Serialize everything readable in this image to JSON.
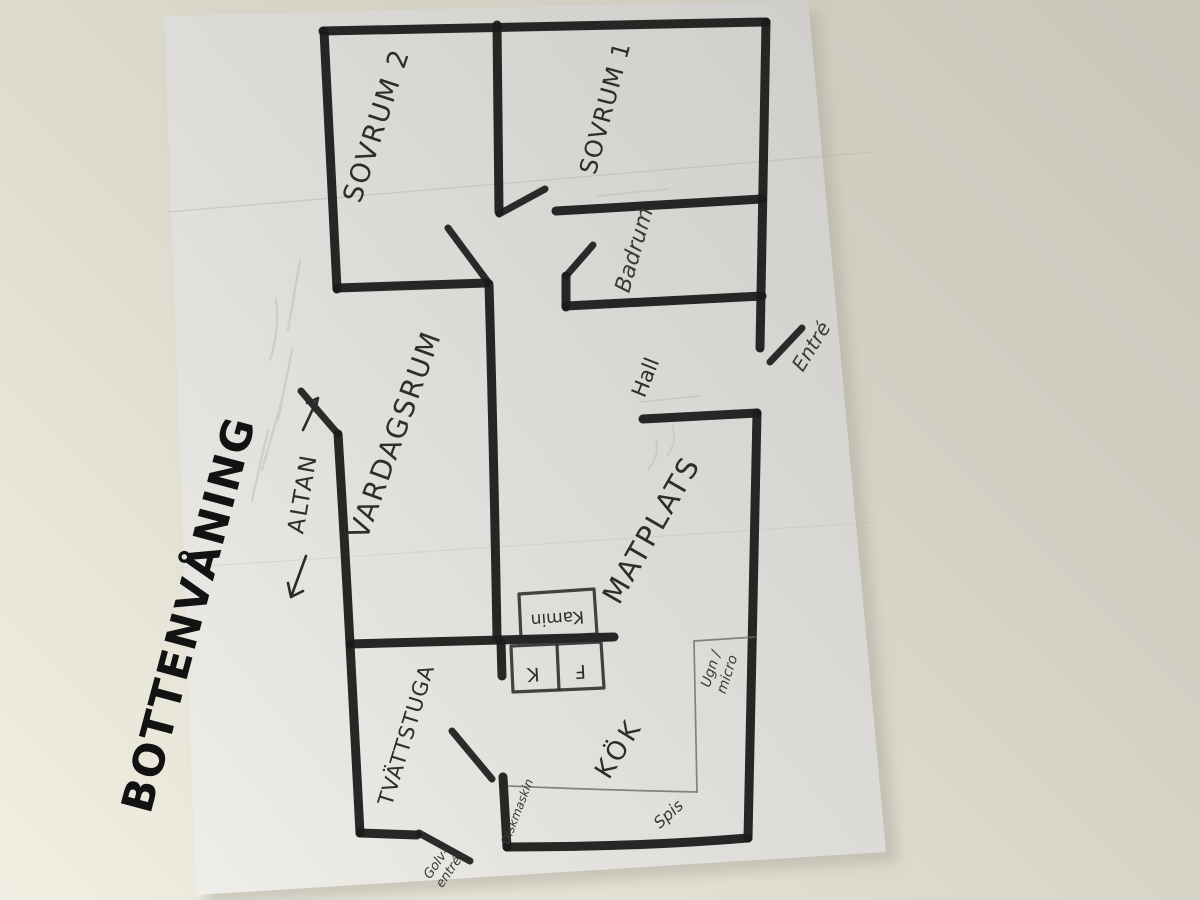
{
  "photo": {
    "paper_color": "#e7e5e0",
    "table_color": "#d5d3c6",
    "ink_color": "#1b1b1b",
    "pencil_color": "#3a3937"
  },
  "title": "BOTTENVÅNING",
  "rooms": {
    "sovrum2": "SOVRUM 2",
    "sovrum1": "SOVRUM 1",
    "badrum": "Badrum",
    "vardagsrum": "VARDAGSRUM",
    "hall": "Hall",
    "matplats": "MATPLATS",
    "tvattstuga": "TVÄTTSTUGA",
    "kok": "KÖK"
  },
  "annotations": {
    "altan": "ALTAN",
    "altan_arrow_left": "←",
    "altan_arrow_right": "→",
    "entre": "Entré",
    "kamin": "Kamin",
    "kyl": "K",
    "frys": "F",
    "ugn_micro_1": "Ugn /",
    "ugn_micro_2": "micro",
    "diskmaskin": "Diskmaskin",
    "spis": "Spis",
    "golv_entre_1": "Golv-",
    "golv_entre_2": "entré"
  }
}
